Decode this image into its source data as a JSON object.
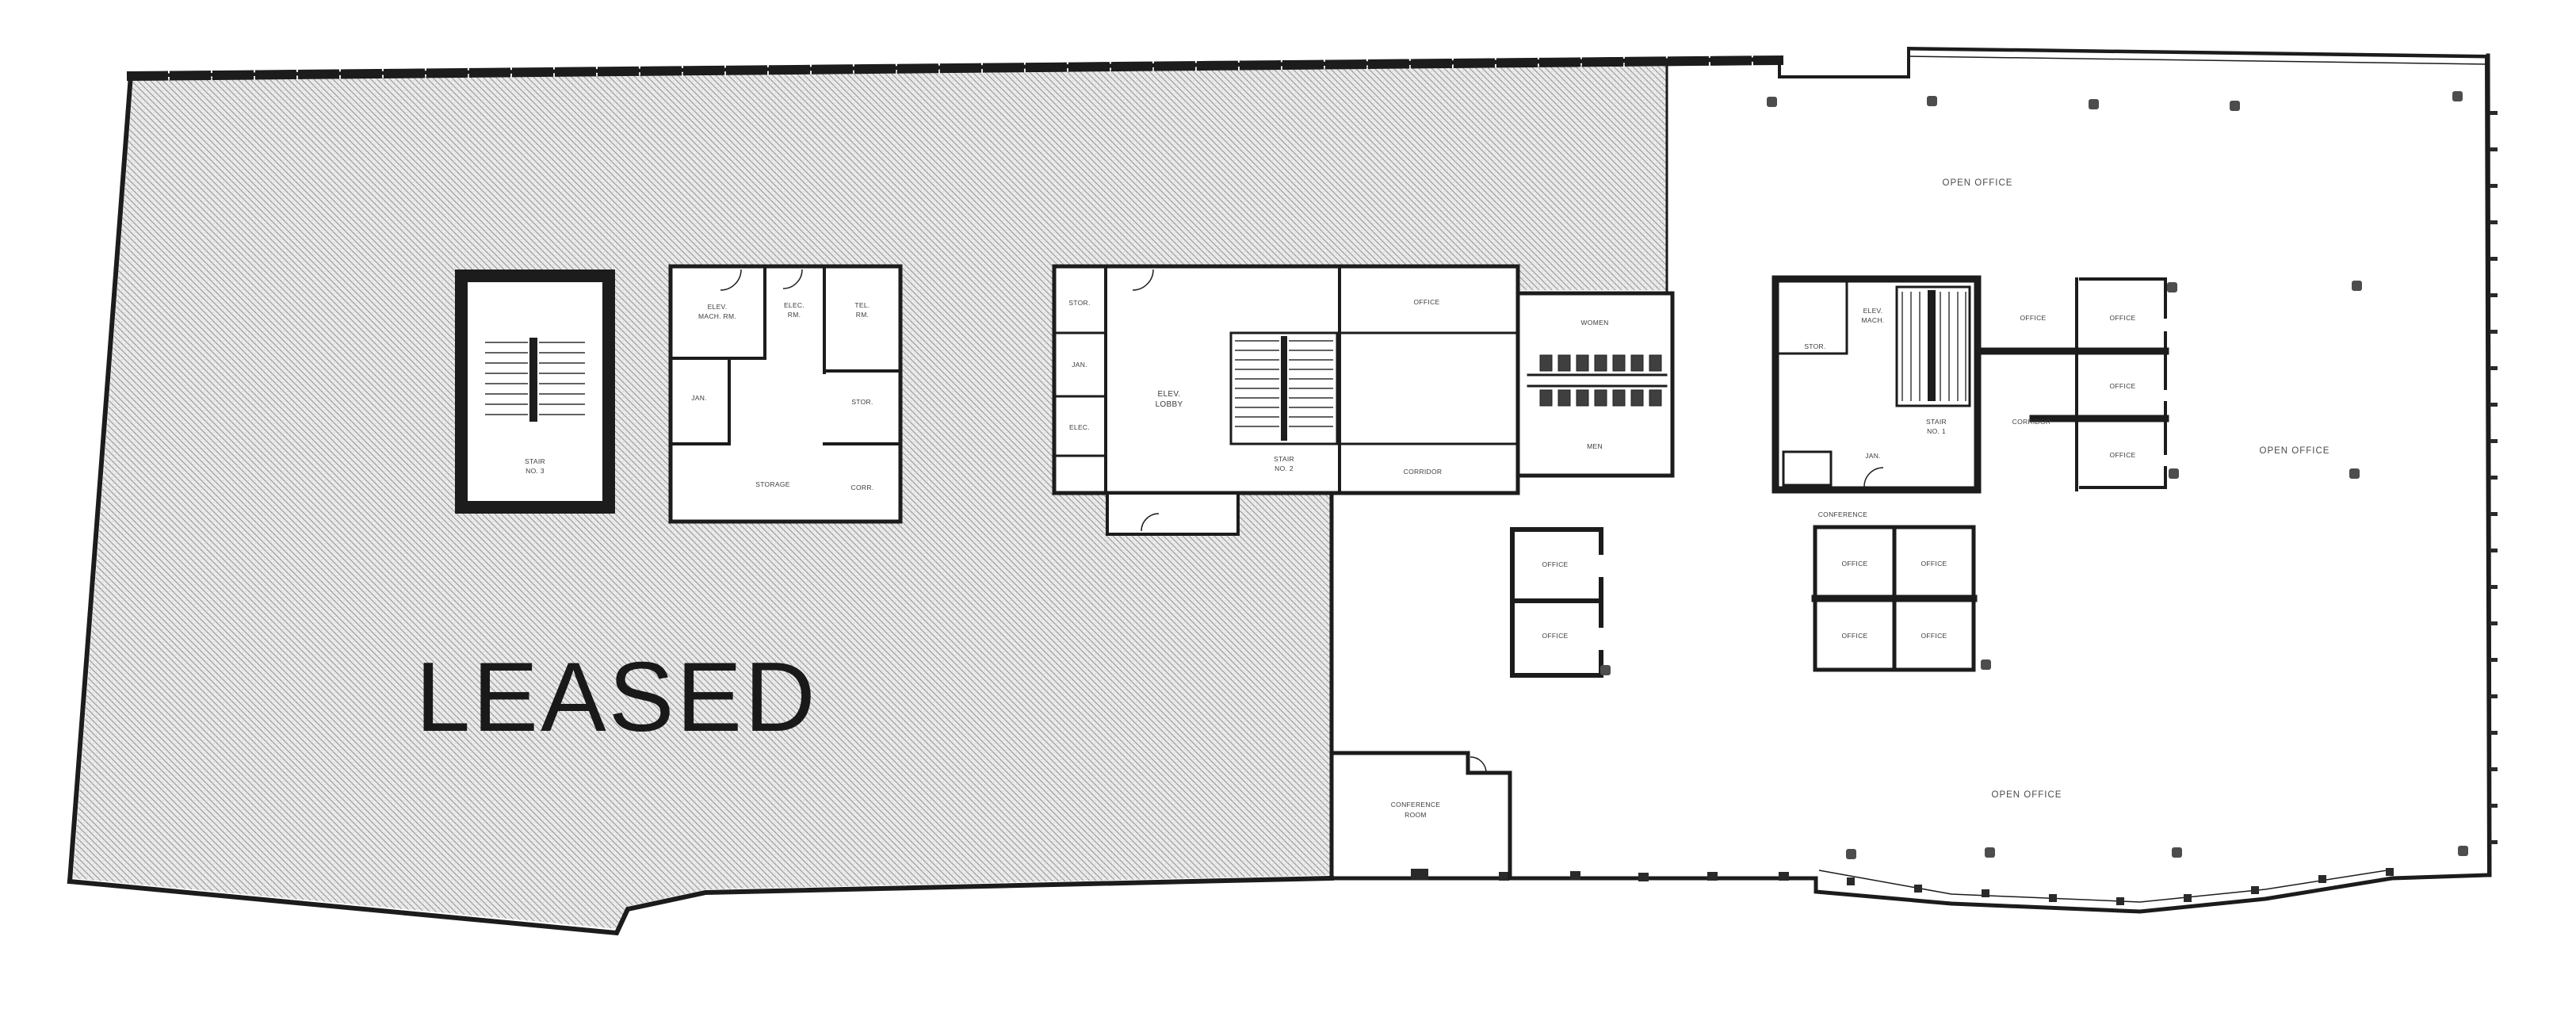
{
  "document": {
    "type": "architectural floor plan",
    "leased_area_label": "LEASED"
  },
  "colors": {
    "background": "#ffffff",
    "wall": "#1c1c1c",
    "hatch_line": "#9b9b9b",
    "hatch_cross": "#d6d6d6",
    "hatch_bg": "#ececec",
    "label_text": "#3c3c3c",
    "column": "#4d4d4d",
    "leased_text": "#191919"
  },
  "labels": {
    "leased": "LEASED",
    "open_office": "OPEN OFFICE",
    "office": "OFFICE",
    "stair_a1": "STAIR",
    "stair_a2": "NO. 3",
    "b_room1a": "ELEV.",
    "b_room1b": "MACH. RM.",
    "b_room2a": "ELEC.",
    "b_room2b": "RM.",
    "b_room3a": "TEL.",
    "b_room3b": "RM.",
    "b_stor": "STOR.",
    "b_jan": "JAN.",
    "b_storage": "STORAGE",
    "b_corr": "CORR.",
    "c_stor": "STOR.",
    "c_jan": "JAN.",
    "c_elec": "ELEC.",
    "c_lobby1": "ELEV.",
    "c_lobby2": "LOBBY",
    "c_stair1": "STAIR",
    "c_stair2": "NO. 2",
    "c_office": "OFFICE",
    "c_corr": "CORRIDOR",
    "wr_women": "WOMEN",
    "wr_men": "MEN",
    "d_stor": "STOR.",
    "d_mach1": "ELEV.",
    "d_mach2": "MACH.",
    "d_jan": "JAN.",
    "d_stair1": "STAIR",
    "d_stair2": "NO. 1",
    "d_conf": "CONFERENCE",
    "e_corr": "CORRIDOR",
    "room_bottom1": "CONFERENCE",
    "room_bottom2": "ROOM"
  }
}
